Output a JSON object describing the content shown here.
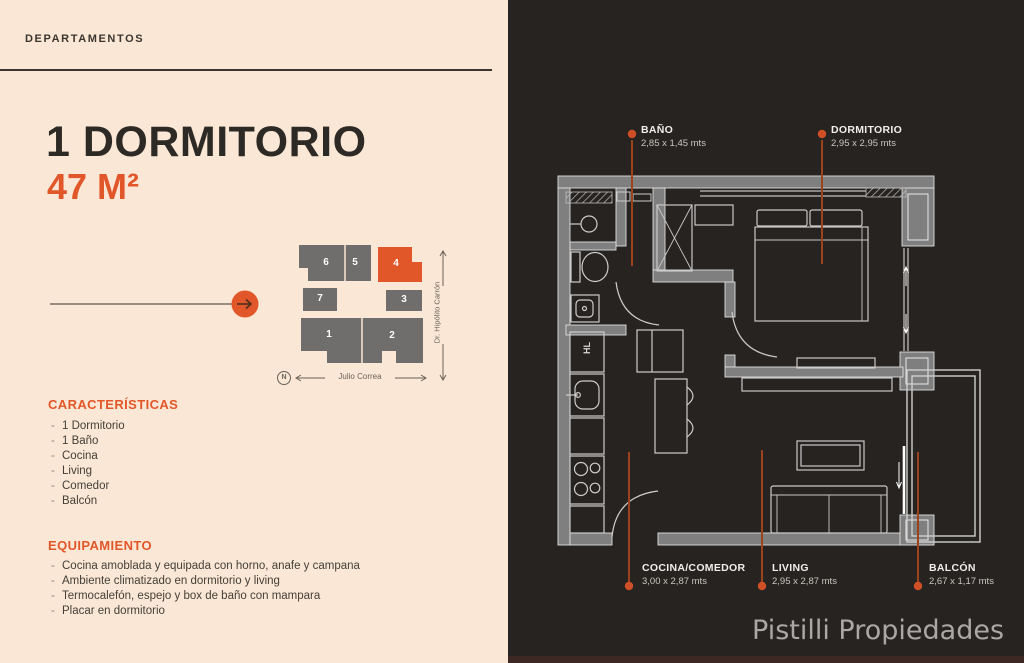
{
  "colors": {
    "accent": "#e2572a",
    "cream": "#fae7d5",
    "panel_dark": "#272320",
    "wall_gray": "#7f7f7f",
    "leader_line": "#9a431d",
    "leader_dot": "#cf5026",
    "block_gray": "#6f6e6c"
  },
  "left_panel": {
    "eyebrow": "DEPARTAMENTOS",
    "title": "1 DORMITORIO",
    "area": "47 M²",
    "map": {
      "units": [
        "6",
        "5",
        "4",
        "7",
        "3",
        "1",
        "2"
      ],
      "street_bottom": "Julio Correa",
      "street_right": "Dr. Hipólito Carrón",
      "compass": "N"
    },
    "features": {
      "heading": "CARACTERÍSTICAS",
      "items": [
        "1 Dormitorio",
        "1 Baño",
        "Cocina",
        "Living",
        "Comedor",
        "Balcón"
      ]
    },
    "equipment": {
      "heading": "EQUIPAMIENTO",
      "items": [
        "Cocina amoblada y equipada con horno, anafe y campana",
        "Ambiente climatizado en dormitorio y living",
        "Termocalefón, espejo y box de baño con mampara",
        "Placar en dormitorio"
      ]
    }
  },
  "plan": {
    "rooms": [
      {
        "name": "BAÑO",
        "dims": "2,85 x 1,45 mts"
      },
      {
        "name": "DORMITORIO",
        "dims": "2,95 x 2,95 mts"
      },
      {
        "name": "COCINA/COMEDOR",
        "dims": "3,00 x 2,87 mts"
      },
      {
        "name": "LIVING",
        "dims": "2,95 x 2,87 mts"
      },
      {
        "name": "BALCÓN",
        "dims": "2,67 x 1,17 mts"
      }
    ],
    "fridge_label": "HL"
  },
  "watermark": "Pistilli Propiedades"
}
